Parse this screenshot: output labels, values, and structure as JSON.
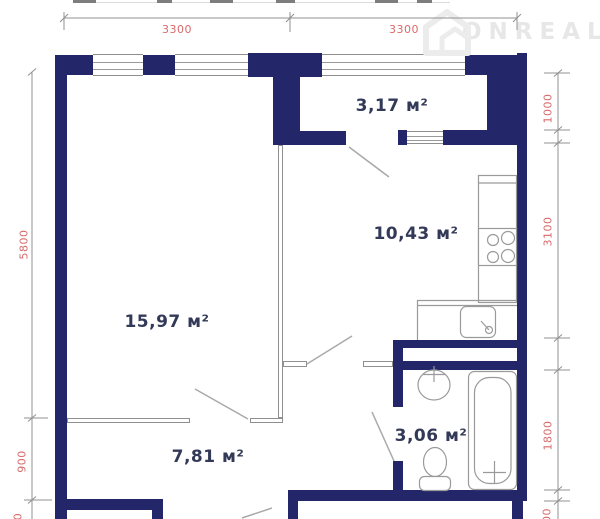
{
  "watermark": {
    "brand": "ONREALT"
  },
  "rooms": {
    "balcony": {
      "label": "3,17 м²"
    },
    "kitchen": {
      "label": "10,43 м²"
    },
    "living": {
      "label": "15,97 м²"
    },
    "hallway": {
      "label": "7,81 м²"
    },
    "bathroom": {
      "label": "3,06 м²"
    }
  },
  "dimensions": {
    "top": [
      "3300",
      "3300"
    ],
    "left": [
      "5800",
      "900"
    ],
    "left_partial": "0",
    "right": [
      "1000",
      "3100",
      "1800"
    ],
    "right_partial": "00"
  },
  "colors": {
    "wall": "#23276a",
    "thin_wall": "#8f8f8f",
    "dimension_text": "#d86a6a",
    "room_label_text": "#333a58",
    "watermark": "#e7e7e7"
  }
}
